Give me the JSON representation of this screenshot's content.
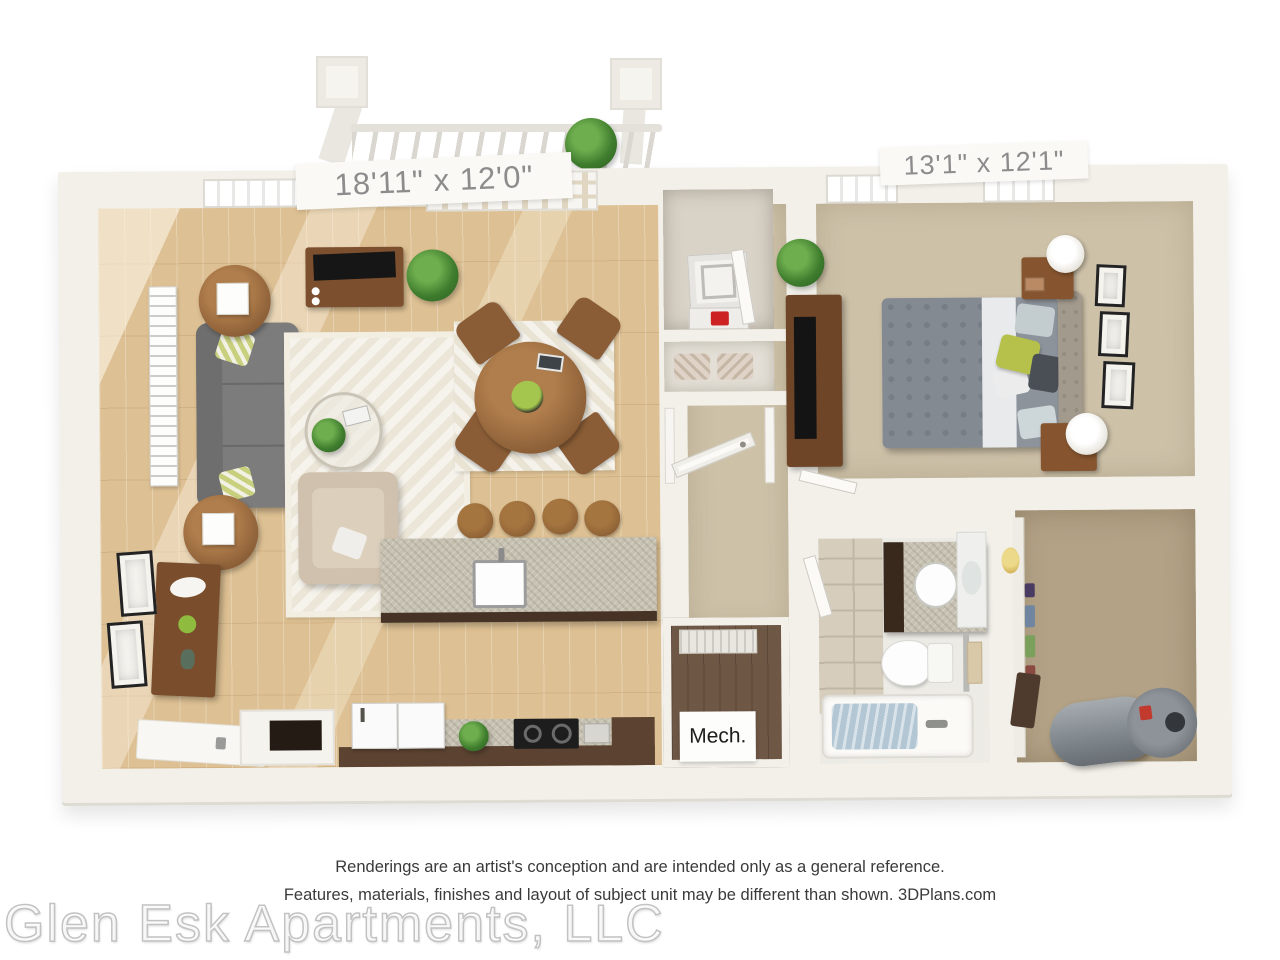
{
  "labels": {
    "living_dim": "18'11\" x 12'0\"",
    "bedroom_dim": "13'1\" x 12'1\"",
    "mech": "Mech."
  },
  "footer": {
    "line1": "Renderings are an artist's conception and are intended only as a general reference.",
    "line2": "Features, materials, finishes and layout of subject unit may be different than shown. 3DPlans.com",
    "watermark": "Glen Esk Apartments, LLC"
  },
  "colors": {
    "background": "#ffffff",
    "wall": "#f2f0e9",
    "wood_floor": "#ddc093",
    "carpet_tan": "#cdc1a8",
    "closet_carpet": "#b3a286",
    "mech_floor": "#6e5745",
    "sofa_gray": "#7c7c7c",
    "wood_furniture": "#8a5d36",
    "dark_cabinet": "#5c4331",
    "accent_green": "#b5c14b",
    "tub_water": "#b2c6d3",
    "label_text": "#8c8c8c",
    "footer_text": "#3a3a3a"
  }
}
